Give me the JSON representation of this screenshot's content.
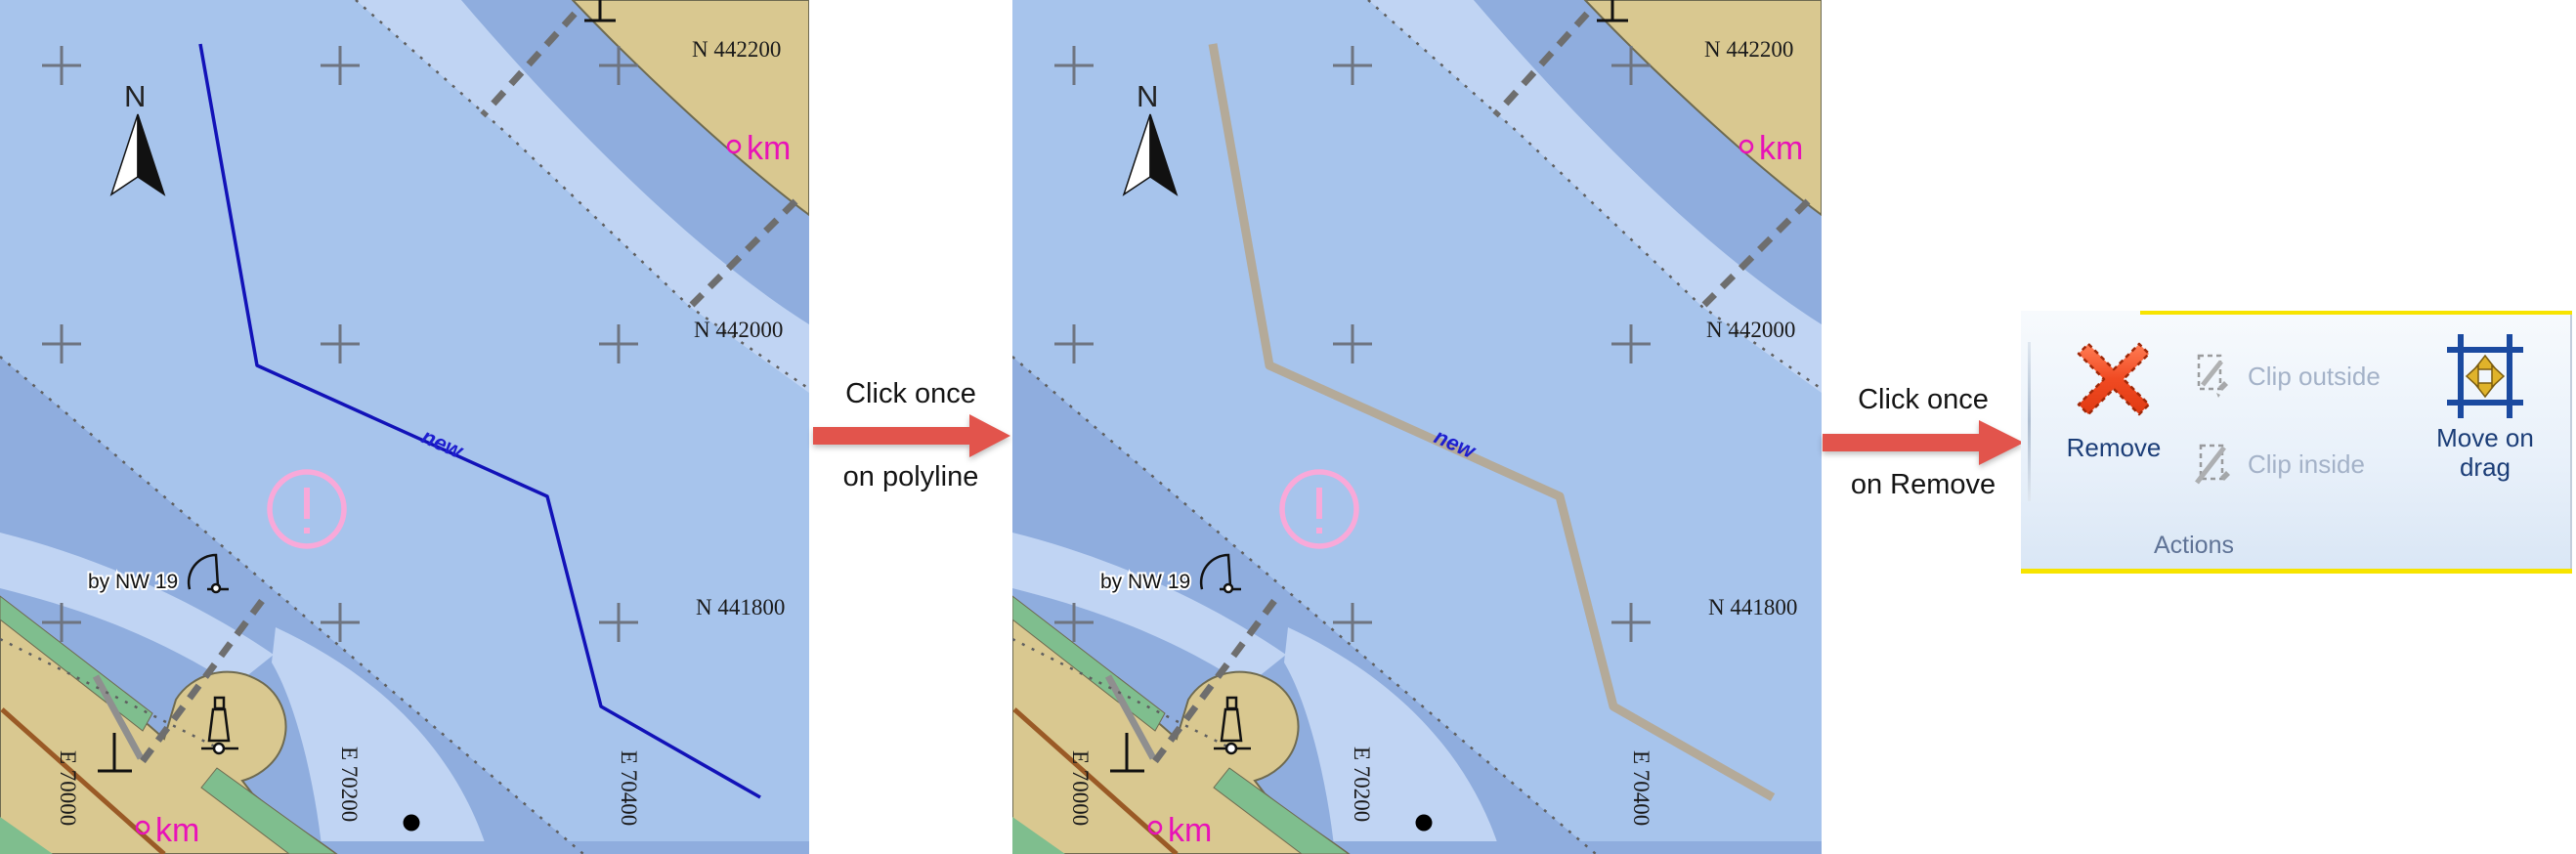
{
  "page": {
    "background": "#ffffff"
  },
  "colors": {
    "water_base": "#a7c4ec",
    "water_pale": "#c0d4f3",
    "water_dark": "#8fadde",
    "land_tan": "#d9c890",
    "land_edge": "#6e6a50",
    "green_shore": "#7fbe8e",
    "road_brown": "#9a5a26",
    "line_gray": "#5f5f5f",
    "cross_gray": "#6e7480",
    "polyline_blue": "#1212b8",
    "polyline_selected_gray": "#b4aa99",
    "magenta": "#e812b8",
    "pink_caution": "#f9a9d9",
    "label_blue": "#1e1ecf",
    "arrow_red": "#e2544c",
    "ribbon_yellow": "#f7e400",
    "ribbon_text_navy": "#1b3d77",
    "ribbon_text_disabled": "#a4b2c8"
  },
  "map_labels": {
    "north": "N",
    "grid_n": [
      "N 442200",
      "N 442000",
      "N 441800"
    ],
    "grid_e": [
      "E 70000",
      "E 70200",
      "E 70400"
    ],
    "km_top": "km",
    "km_bottom": "km",
    "landmark": "by NW 19",
    "polyline_name": "new"
  },
  "maps": [
    {
      "id": "map-before",
      "polyline_state": "default"
    },
    {
      "id": "map-after",
      "polyline_state": "selected"
    }
  ],
  "annotations": [
    {
      "line1": "Click once",
      "line2": "on polyline"
    },
    {
      "line1": "Click once",
      "line2": "on Remove"
    }
  ],
  "ribbon": {
    "group_label": "Actions",
    "buttons": [
      {
        "label": "Remove",
        "enabled": true
      },
      {
        "label": "Clip outside",
        "enabled": false
      },
      {
        "label": "Clip inside",
        "enabled": false
      },
      {
        "label": "Move on drag",
        "enabled": true
      }
    ]
  }
}
